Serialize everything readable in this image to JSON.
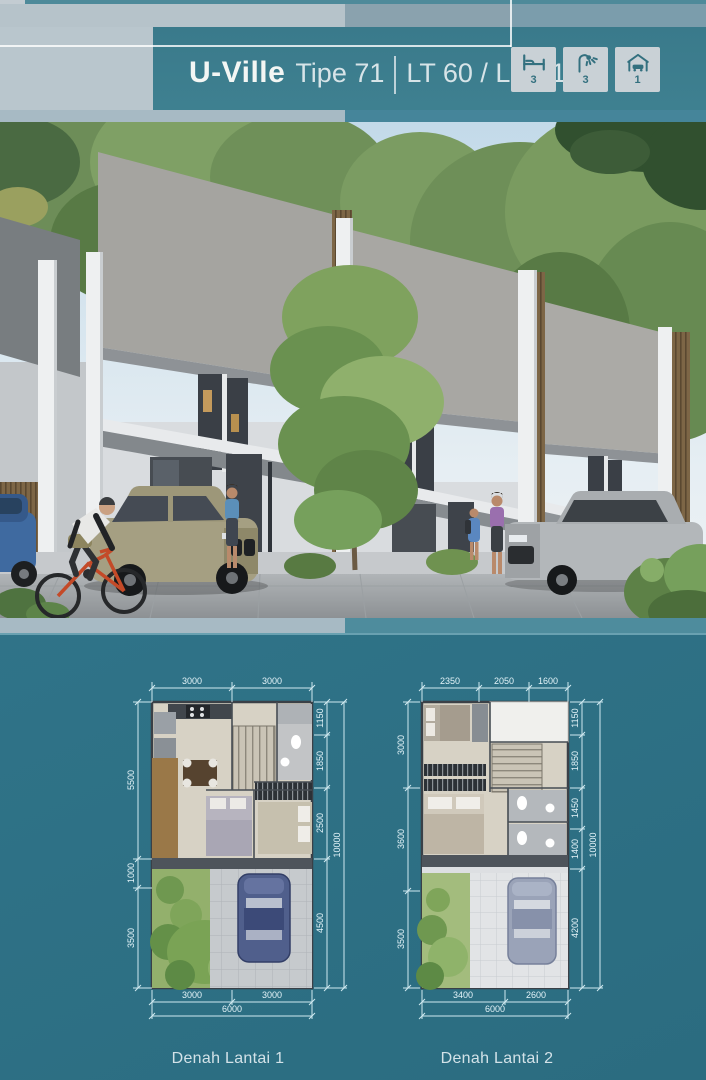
{
  "header": {
    "title_bold": "U-Ville",
    "title_type": "Tipe 71",
    "title_specs": "LT 60 / LB 71",
    "features": [
      {
        "name": "bedrooms",
        "icon": "bed-icon",
        "count": "3"
      },
      {
        "name": "bathrooms",
        "icon": "shower-icon",
        "count": "3"
      },
      {
        "name": "carport",
        "icon": "garage-icon",
        "count": "1"
      }
    ]
  },
  "floor_plans": [
    {
      "caption": "Denah Lantai 1",
      "dims_top": [
        "3000",
        "3000"
      ],
      "dims_left": [
        "5500",
        "1000",
        "3500"
      ],
      "dims_right": [
        "1150",
        "1850",
        "2500",
        "4500"
      ],
      "dim_right_total": "10000",
      "dims_bottom": [
        "3000",
        "3000"
      ],
      "dim_bottom_total": "6000"
    },
    {
      "caption": "Denah Lantai 2",
      "dims_top": [
        "2350",
        "2050",
        "1600"
      ],
      "dims_left": [
        "3000",
        "3600",
        "3500"
      ],
      "dims_right": [
        "1150",
        "1850",
        "1450",
        "1400",
        "4200"
      ],
      "dim_right_total": "10000",
      "dims_bottom": [
        "3400",
        "2600"
      ],
      "dim_bottom_total": "6000"
    }
  ],
  "colors": {
    "background_teal": "#2f7487",
    "header_teal": "#3e8090",
    "panel_gray": "#b9c6cd",
    "dim_line": "#cfe9f0",
    "tile_bg": "#c9d1d6"
  }
}
